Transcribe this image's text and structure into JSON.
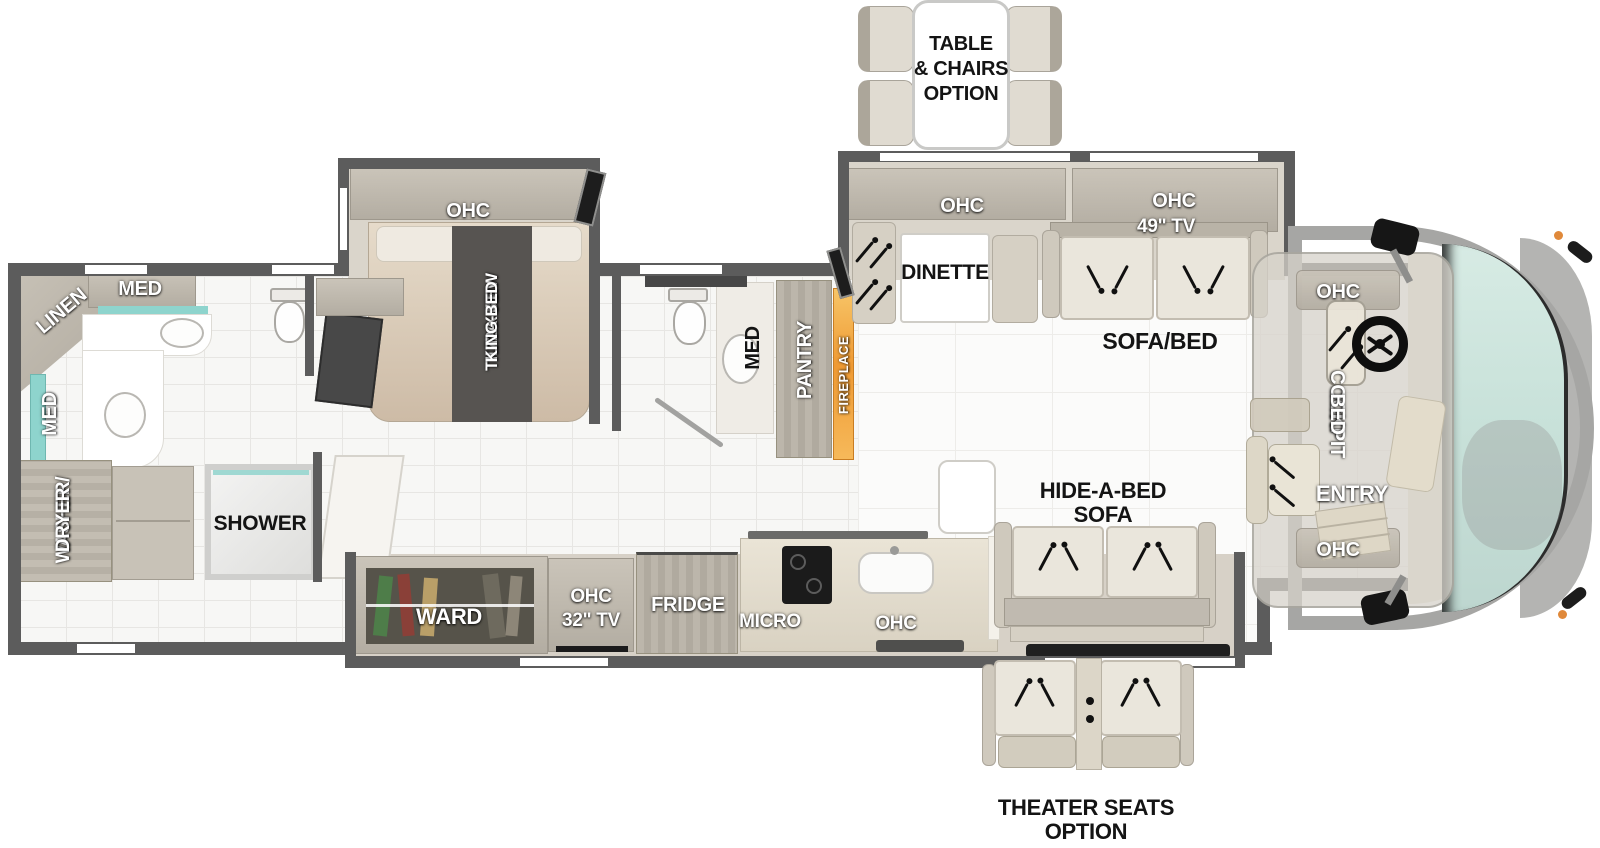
{
  "floorplan": {
    "options": {
      "table_chairs": {
        "line1": "TABLE",
        "line2": "& CHAIRS",
        "line3": "OPTION"
      },
      "theater_seats": {
        "line1": "THEATER SEATS",
        "line2": "OPTION"
      }
    },
    "bedroom": {
      "ohc": "OHC",
      "bed_line1": "72 X 80",
      "bed_line2": "TILT-A-VIEW",
      "bed_line3": "KING BED"
    },
    "rear_bath": {
      "linen": "LINEN",
      "med_top": "MED",
      "med_side": "MED",
      "washer_line1": "WASHER/",
      "washer_line2": "DRYER",
      "shower": "SHOWER"
    },
    "mid_bath": {
      "med": "MED",
      "pantry": "PANTRY",
      "fireplace": "FIREPLACE"
    },
    "living": {
      "dinette_ohc": "OHC",
      "dinette": "DINETTE",
      "tv_ohc": "OHC",
      "tv_size": "49\" TV",
      "sofa_bed": "SOFA/BED",
      "hide_line1": "HIDE-A-BED",
      "hide_line2": "SOFA"
    },
    "kitchen": {
      "ward": "WARD",
      "tv_line1": "OHC",
      "tv_line2": "32\" TV",
      "fridge": "FRIDGE",
      "micro": "MICRO",
      "ohc": "OHC"
    },
    "cockpit": {
      "ohc_top": "OHC",
      "bed_line1": "COCKPIT",
      "bed_line2": "BED",
      "entry": "ENTRY",
      "ohc_bottom": "OHC"
    },
    "colors": {
      "accent_teal": "#8ed4cd",
      "fireplace_orange": "#ef9a33",
      "wall_gray": "#5c5c5c"
    }
  }
}
